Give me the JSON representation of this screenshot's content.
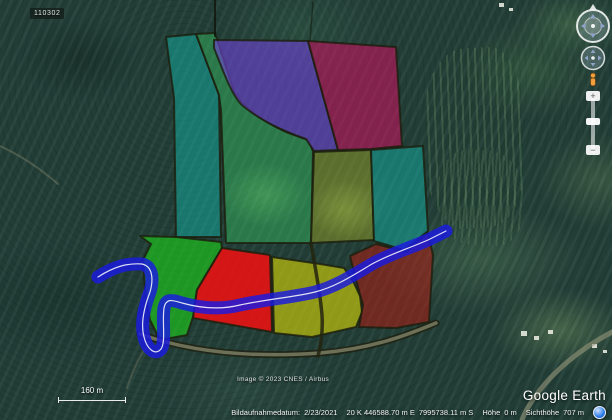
{
  "window": {
    "app_name": "Google Earth"
  },
  "placemark": {
    "label": "110302"
  },
  "scale_bar": {
    "label": "160 m"
  },
  "attribution": {
    "text": "Image © 2023 CNES / Airbus"
  },
  "branding": {
    "logo": "Google Earth"
  },
  "status_bar": {
    "imagery_date_label": "Bildaufnahmedatum:",
    "imagery_date": "2/23/2021",
    "utm_easting": "20 K 446588.70 m E",
    "utm_northing": "7995738.11 m S",
    "elevation_label": "Höhe",
    "elevation_value": "0 m",
    "eye_altitude_label": "Sichthöhe",
    "eye_altitude_value": "707 m"
  },
  "navigation": {
    "zoom_in_label": "+",
    "zoom_out_label": "−"
  },
  "map": {
    "overlay": {
      "border_color": "#1c1e0d",
      "border_width": 2,
      "parcels": [
        {
          "name": "teal-left",
          "points": "166,37 196,34 219,95 221,237 176,237 174,98",
          "fill": "#14b2a6",
          "opacity": 0.5
        },
        {
          "name": "green-upper",
          "path": "M196,34 L215,33 L234,92 C244,108 262,121 286,132 L308,140 L313,151 L311,243 L226,243 L221,110 L219,95 Z",
          "fill": "#37c463",
          "opacity": 0.45
        },
        {
          "name": "purple",
          "path": "M214,40 L308,41 L338,150 L314,151 L306,139 C283,131 260,120 243,106 C232,97 222,68 214,48 Z",
          "fill": "#6f42d8",
          "opacity": 0.6
        },
        {
          "name": "crimson",
          "points": "308,41 396,47 402,146 371,149 338,150",
          "fill": "#d40e62",
          "opacity": 0.55
        },
        {
          "name": "olive",
          "points": "314,152 371,150 374,240 311,243",
          "fill": "#a3aa24",
          "opacity": 0.45
        },
        {
          "name": "teal-right",
          "points": "371,150 423,146 428,231 404,250 374,241",
          "fill": "#14b2a6",
          "opacity": 0.5
        },
        {
          "name": "bright-green",
          "path": "M140,236 L176,237 L221,242 L222,248 L197,290 L193,317 L187,335 L160,340 L150,320 L145,290 L143,260 L151,244 Z",
          "fill": "#1ed41a",
          "opacity": 0.6
        },
        {
          "name": "red",
          "points": "222,248 270,255 272,332 193,318 197,290",
          "fill": "#f31111",
          "opacity": 0.85
        },
        {
          "name": "yellow",
          "path": "M272,257 L320,264 L344,268 L353,281 L360,296 L362,312 L356,327 L312,337 L274,333 Z",
          "fill": "#c6c60a",
          "opacity": 0.68
        },
        {
          "name": "dark-red",
          "path": "M350,256 L376,244 L406,252 L428,233 L433,255 L429,322 L396,328 L359,327 L363,305 L356,280 Z",
          "fill": "#b01c12",
          "opacity": 0.55
        }
      ],
      "river": {
        "name": "river",
        "path": "M98,277 C115,266 128,263 142,264 C152,266 154,278 150,292 C145,305 140,322 144,337 C147,349 155,356 161,349 C166,342 162,322 164,308 C166,298 172,300 182,303 C200,308 220,310 240,305 C268,299 295,297 315,292 C335,287 352,276 372,264 C390,254 410,248 428,240 C436,236 442,233 446,231",
        "color": "#1a1ae0",
        "width": 13,
        "opacity": 0.82,
        "centerline_color": "#ffffff",
        "centerline_width": 1.2,
        "centerline_opacity": 0.85
      },
      "roads": [
        {
          "name": "trail-top-left",
          "layer": "under",
          "path": "M0,146 C22,156 42,170 58,184",
          "color": "#8a8a6f",
          "width": 2,
          "opacity": 0.4
        },
        {
          "name": "trail-bottom-left",
          "layer": "under",
          "path": "M150,340 C140,355 132,372 127,388",
          "color": "#8a8a6f",
          "width": 2,
          "opacity": 0.35
        },
        {
          "name": "road-bottom-right",
          "layer": "under",
          "path": "M612,332 C580,349 552,372 534,398 C528,407 524,414 522,420",
          "color": "#97977b",
          "width": 5,
          "opacity": 0.6
        },
        {
          "name": "boundary-road-casing",
          "layer": "over",
          "path": "M140,334 C190,352 250,358 320,353 C370,349 405,336 436,323",
          "color": "#1f2112",
          "width": 7,
          "opacity": 0.8
        },
        {
          "name": "boundary-road",
          "layer": "over",
          "path": "M140,334 C190,352 250,358 320,353 C370,349 405,336 436,323",
          "color": "#8f9070",
          "width": 3.5,
          "opacity": 0.7
        },
        {
          "name": "farm-track",
          "layer": "over",
          "path": "M311,243 C314,262 320,290 322,315 C323,332 321,345 318,356",
          "color": "#23240f",
          "width": 3.5,
          "opacity": 0.85
        },
        {
          "name": "fence-line-1",
          "layer": "over",
          "path": "M215,0 L215,36",
          "color": "#101408",
          "width": 2,
          "opacity": 0.8
        },
        {
          "name": "fence-line-2",
          "layer": "over",
          "path": "M313,2 L310,41",
          "color": "#101408",
          "width": 1.5,
          "opacity": 0.5
        }
      ]
    },
    "terrain": {
      "buildings": [
        {
          "x": 521,
          "y": 331,
          "w": 6,
          "h": 5
        },
        {
          "x": 534,
          "y": 336,
          "w": 5,
          "h": 4
        },
        {
          "x": 548,
          "y": 330,
          "w": 5,
          "h": 4
        },
        {
          "x": 592,
          "y": 344,
          "w": 5,
          "h": 4
        },
        {
          "x": 603,
          "y": 350,
          "w": 4,
          "h": 3
        },
        {
          "x": 499,
          "y": 3,
          "w": 5,
          "h": 4
        },
        {
          "x": 509,
          "y": 8,
          "w": 4,
          "h": 3
        }
      ]
    }
  }
}
